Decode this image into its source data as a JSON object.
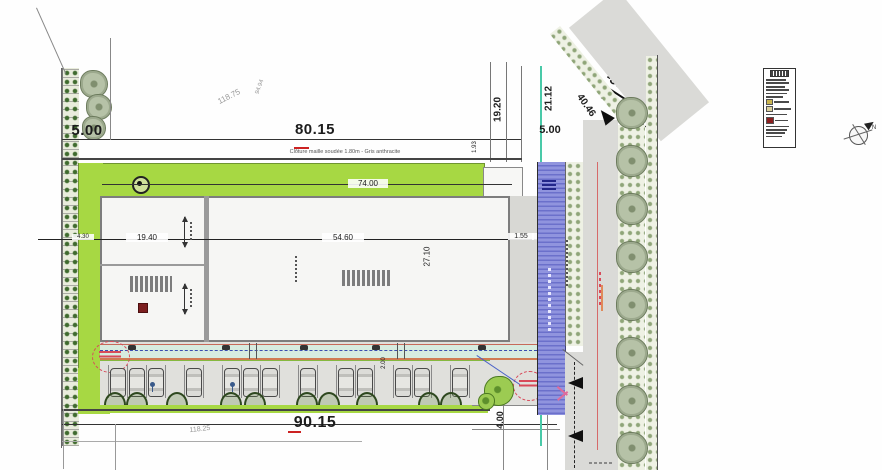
{
  "plan": {
    "fence_note": "Clôture maille soudée 1.80m - Gris anthracite",
    "dimensions": {
      "top_left_setback": "5.00",
      "top_width": "80.15",
      "right_d1": "19.20",
      "right_d2": "21.12",
      "right_setback": "5.00",
      "road_diag": "40.46",
      "road_level": "-37.31",
      "road_len": "137.91",
      "parcel_diag_1": "118.75",
      "parcel_diag_2": "94.94",
      "building_front": "74.00",
      "room_width": "19.40",
      "hall_width": "54.60",
      "hall_depth": "27.10",
      "gap_1": "1.55",
      "gap_2": "5.00",
      "step_h": "1.93",
      "left_small": "4.30",
      "path_w": "2.00",
      "bottom_width": "90.15",
      "parcel_bottom": "118.25",
      "entrance_w": "4.00"
    },
    "compass": {
      "north": "N"
    }
  },
  "colors": {
    "landscape_green": "#a7d843",
    "fire_lane_blue": "#8d90da",
    "road_gray": "#dadad7",
    "dim_red": "#cc2222",
    "legend_dark_red": "#8b1f1f",
    "legend_tan": "#c9b44f",
    "utility_teal": "#49c9a8"
  }
}
